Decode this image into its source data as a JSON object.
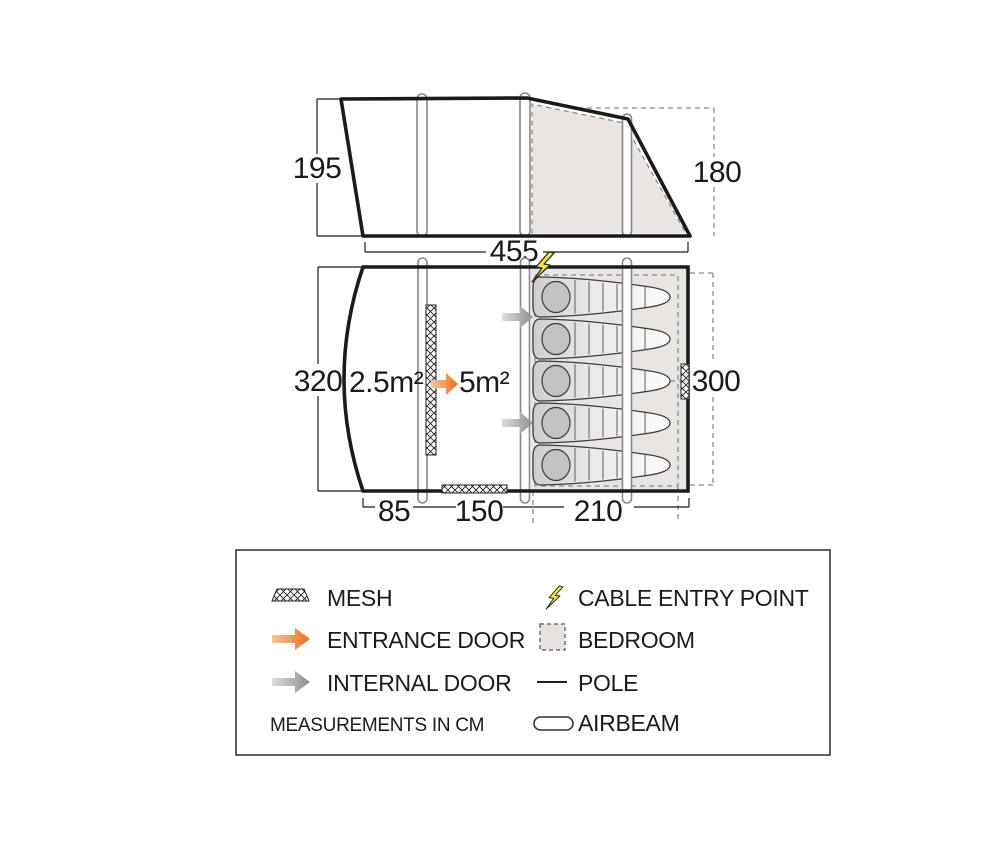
{
  "side_view": {
    "label_height_left": "195",
    "label_height_right": "180",
    "label_width": "455"
  },
  "floor_plan": {
    "label_height_left": "320",
    "label_height_right": "300",
    "porch_area": "2.5m²",
    "living_area": "5m²",
    "dim_porch": "85",
    "dim_living": "150",
    "dim_bedroom": "210"
  },
  "legend": {
    "mesh_label": "MESH",
    "entrance_door_label": "ENTRANCE DOOR",
    "internal_door_label": "INTERNAL DOOR",
    "note": "MEASUREMENTS IN CM",
    "cable_entry_label": "CABLE ENTRY POINT",
    "bedroom_label": "BEDROOM",
    "pole_label": "POLE",
    "airbeam_label": "AIRBEAM"
  },
  "colors": {
    "outline": "#1b1b1b",
    "bedroom_fill": "#e8e5e2",
    "entrance_arrow": "#ec6f1f",
    "internal_arrow": "#8f8f8f",
    "cable_yellow": "#f2e93d",
    "pillow_gray": "#c4c2c0"
  }
}
